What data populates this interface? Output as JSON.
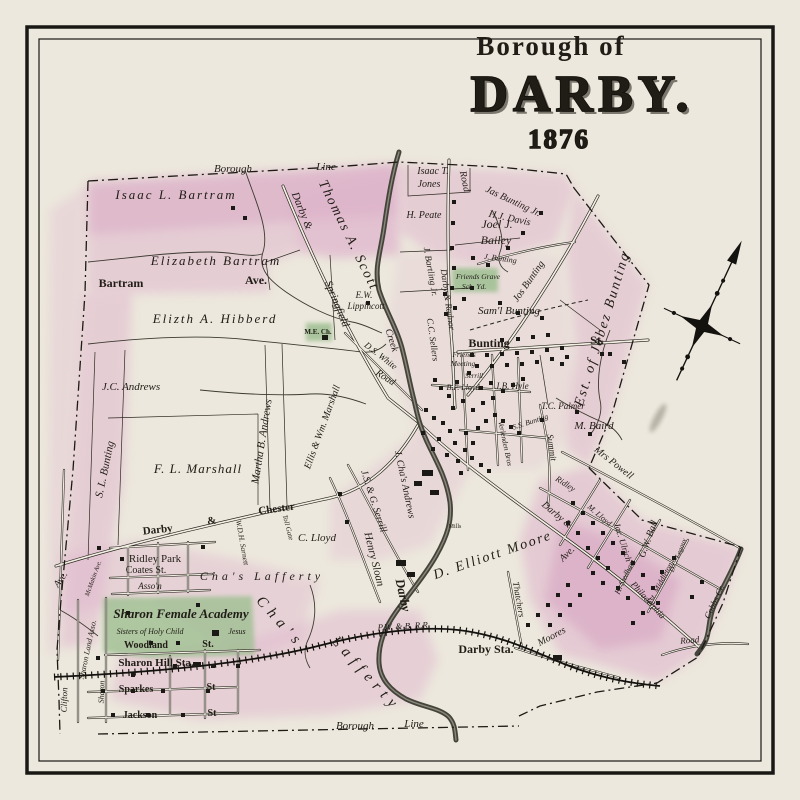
{
  "title": {
    "borough_of": "Borough of",
    "name": "DARBY.",
    "year": "1876"
  },
  "colors": {
    "paper": "#ece8dd",
    "pink": "#dfb3cc",
    "deep_pink": "#d193bb",
    "green": "#9fbf92",
    "ink": "#201c16",
    "creek": "#45443c"
  },
  "labels": {
    "borough_line_top_1": "Borough",
    "borough_line_top_2": "Line",
    "isaac_bartram": "Isaac L. Bartram",
    "elizabeth_bartram": "Elizabeth Bartram",
    "bartram_ave_1": "Bartram",
    "bartram_ave_2": "Ave.",
    "hibberd": "Elizth A. Hibberd",
    "thomas_scott": "Thomas A. Scott",
    "darby_springfield_1": "Darby &",
    "darby_springfield_2": "Springfield",
    "ds_white": "D.S. White",
    "ds_white_road": "Road",
    "isaac_jones_1": "Isaac T.",
    "isaac_jones_2": "Jones",
    "road_top": "Road",
    "jas_bunting": "Jas Bunting Jr.",
    "hj_davis": "H.J. Davis",
    "joel_bailey_1": "Joel J.",
    "joel_bailey_2": "Bailey",
    "h_peate": "H. Peate",
    "j_bunting_sm": "J. Bunting",
    "friends_grave_1": "Friends Grave",
    "friends_grave_2": "Sch. Yd.",
    "jos_bunting": "Jos Bunting",
    "saml_bunting": "Sam'l Bunting",
    "est_jabez": "Est. of Jabez Bunting",
    "bunting_st_1": "Bunting",
    "bunting_st_2": "St.",
    "jc_andrews": "J.C. Andrews",
    "sl_bunting": "S. L. Bunting",
    "fl_marshall": "F. L. Marshall",
    "martha_andrews": "Martha B. Andrews",
    "ellis_marshall": "Ellis & Wm. Marshall",
    "ew_lippincott_1": "E.W.",
    "ew_lippincott_2": "Lippincott",
    "me_ch": "M.E. Ch.",
    "creek_label": "Creek",
    "darby_creek_label": "Darby",
    "j_bartling": "J. Bartling Jr.",
    "darby_radnor": "Darby & Radnor",
    "cc_sellers": "C.C. Sellers",
    "friends_meeting_1": "Friends",
    "friends_meeting_2": "Meeting",
    "serrill_st": "Serrill",
    "bf_lloyd": "B.F. Lloyd",
    "jb_hyle": "J.B. Hyle",
    "tc_palmer": "T.C. Palmer",
    "m_baird": "M. Baird",
    "mrs_powell": "Mrs Powell",
    "summit": "Summit",
    "ss_bunting": "S.S. Bunting",
    "verlenden": "Verlenden Bros",
    "ridley_st": "Ridley",
    "jac_ulrich": "Jac. Ulrich",
    "gw_ball": "G.W. Ball",
    "h_stedham": "H. Stedham",
    "dc_legaux": "D.C. Legaux",
    "middleton": "Est. Middleton",
    "cobbs_cr": "Cobbs Cr.",
    "philadelphia": "Philadelphia",
    "road_bottom_right": "Road",
    "d_elliott_moore": "D. Elliott Moore",
    "henry_sloan": "Henry Sloan",
    "jsg_serrill": "J.S. & G. Serrill",
    "j_chas_andrews": "J. Cha's Andrews",
    "mills": "Mills",
    "chas_lafferty_sm": "Cha's Lafferty",
    "chas_big_1": "Cha's",
    "chas_big_2": "Lafferty",
    "darby_chester_1": "Darby",
    "darby_chester_2": "&",
    "darby_chester_3": "Chester",
    "toll_gate": "Toll Gate",
    "c_lloyd": "C. Lloyd",
    "wdh_sarnell": "W.D.H. Sarnett",
    "ridley_park": "Ridley Park",
    "coates_st": "Coates St.",
    "asson": "Asso'n",
    "sharon_academy": "Sharon Female Academy",
    "sisters_1": "Sisters of Holy Child",
    "sisters_2": "Jesus",
    "woodland_1": "Woodland",
    "woodland_2": "St.",
    "sharon_hill_sta": "Sharon Hill Sta.",
    "sparkes_1": "Sparkes",
    "sparkes_2": "St",
    "jackson_1": "Jackson",
    "jackson_2": "St",
    "clifton": "Clifton",
    "ave_left": "Ave.",
    "mcmakin": "McMakin Ave.",
    "sharon_land": "Sharon Land Asso.",
    "sharon_st": "Sharon",
    "borough_line_bottom_1": "Borough",
    "borough_line_bottom_2": "Line",
    "pwb_rr": "P.W. & B. R.R.",
    "darby_sta": "Darby Sta.",
    "thatchers": "Thatchers",
    "moores": "Moores",
    "ave_mid": "Ave.",
    "darby_main_1": "Darby &",
    "m_lloyd": "M. Lloyd"
  }
}
